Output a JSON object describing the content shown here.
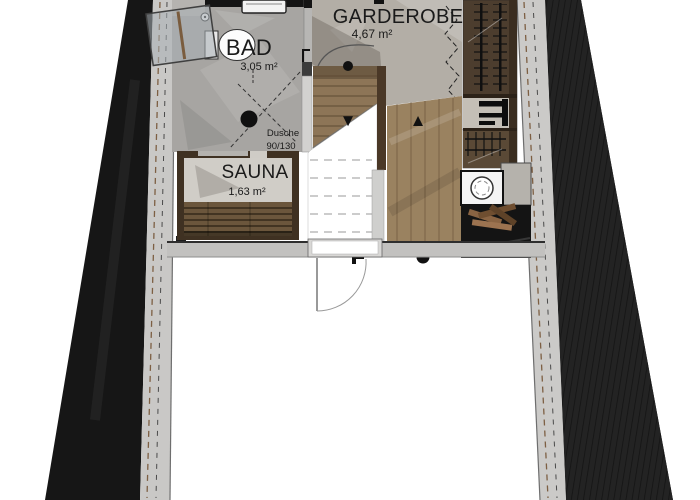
{
  "floorplan": {
    "rooms": [
      {
        "id": "bad",
        "label": "BAD",
        "area": "3,05 m²"
      },
      {
        "id": "garderobe",
        "label": "GARDEROBE",
        "area": "4,67 m²"
      },
      {
        "id": "sauna",
        "label": "SAUNA",
        "area": "1,63 m²"
      }
    ],
    "shower": {
      "label": "Dusche",
      "size": "90/130"
    },
    "icons": {
      "arrow_down": "▼",
      "arrow_up": "▲"
    },
    "colors": {
      "roof_left": "#161616",
      "roof_right": "#222222",
      "wall": "#c9c8c6",
      "wall_dash": "#7d5f43",
      "marble_bad": "#a7a5a2",
      "marble_garderobe": "#b3aea6",
      "wood_floor": "#9a8260",
      "stair_wood": "#8d7557",
      "sauna_frame": "#3f3122",
      "sauna_bench": "#6b563c",
      "wardrobe": "#4c3d2e",
      "fireplace": "#141414",
      "text": "#1a1a1a"
    }
  }
}
